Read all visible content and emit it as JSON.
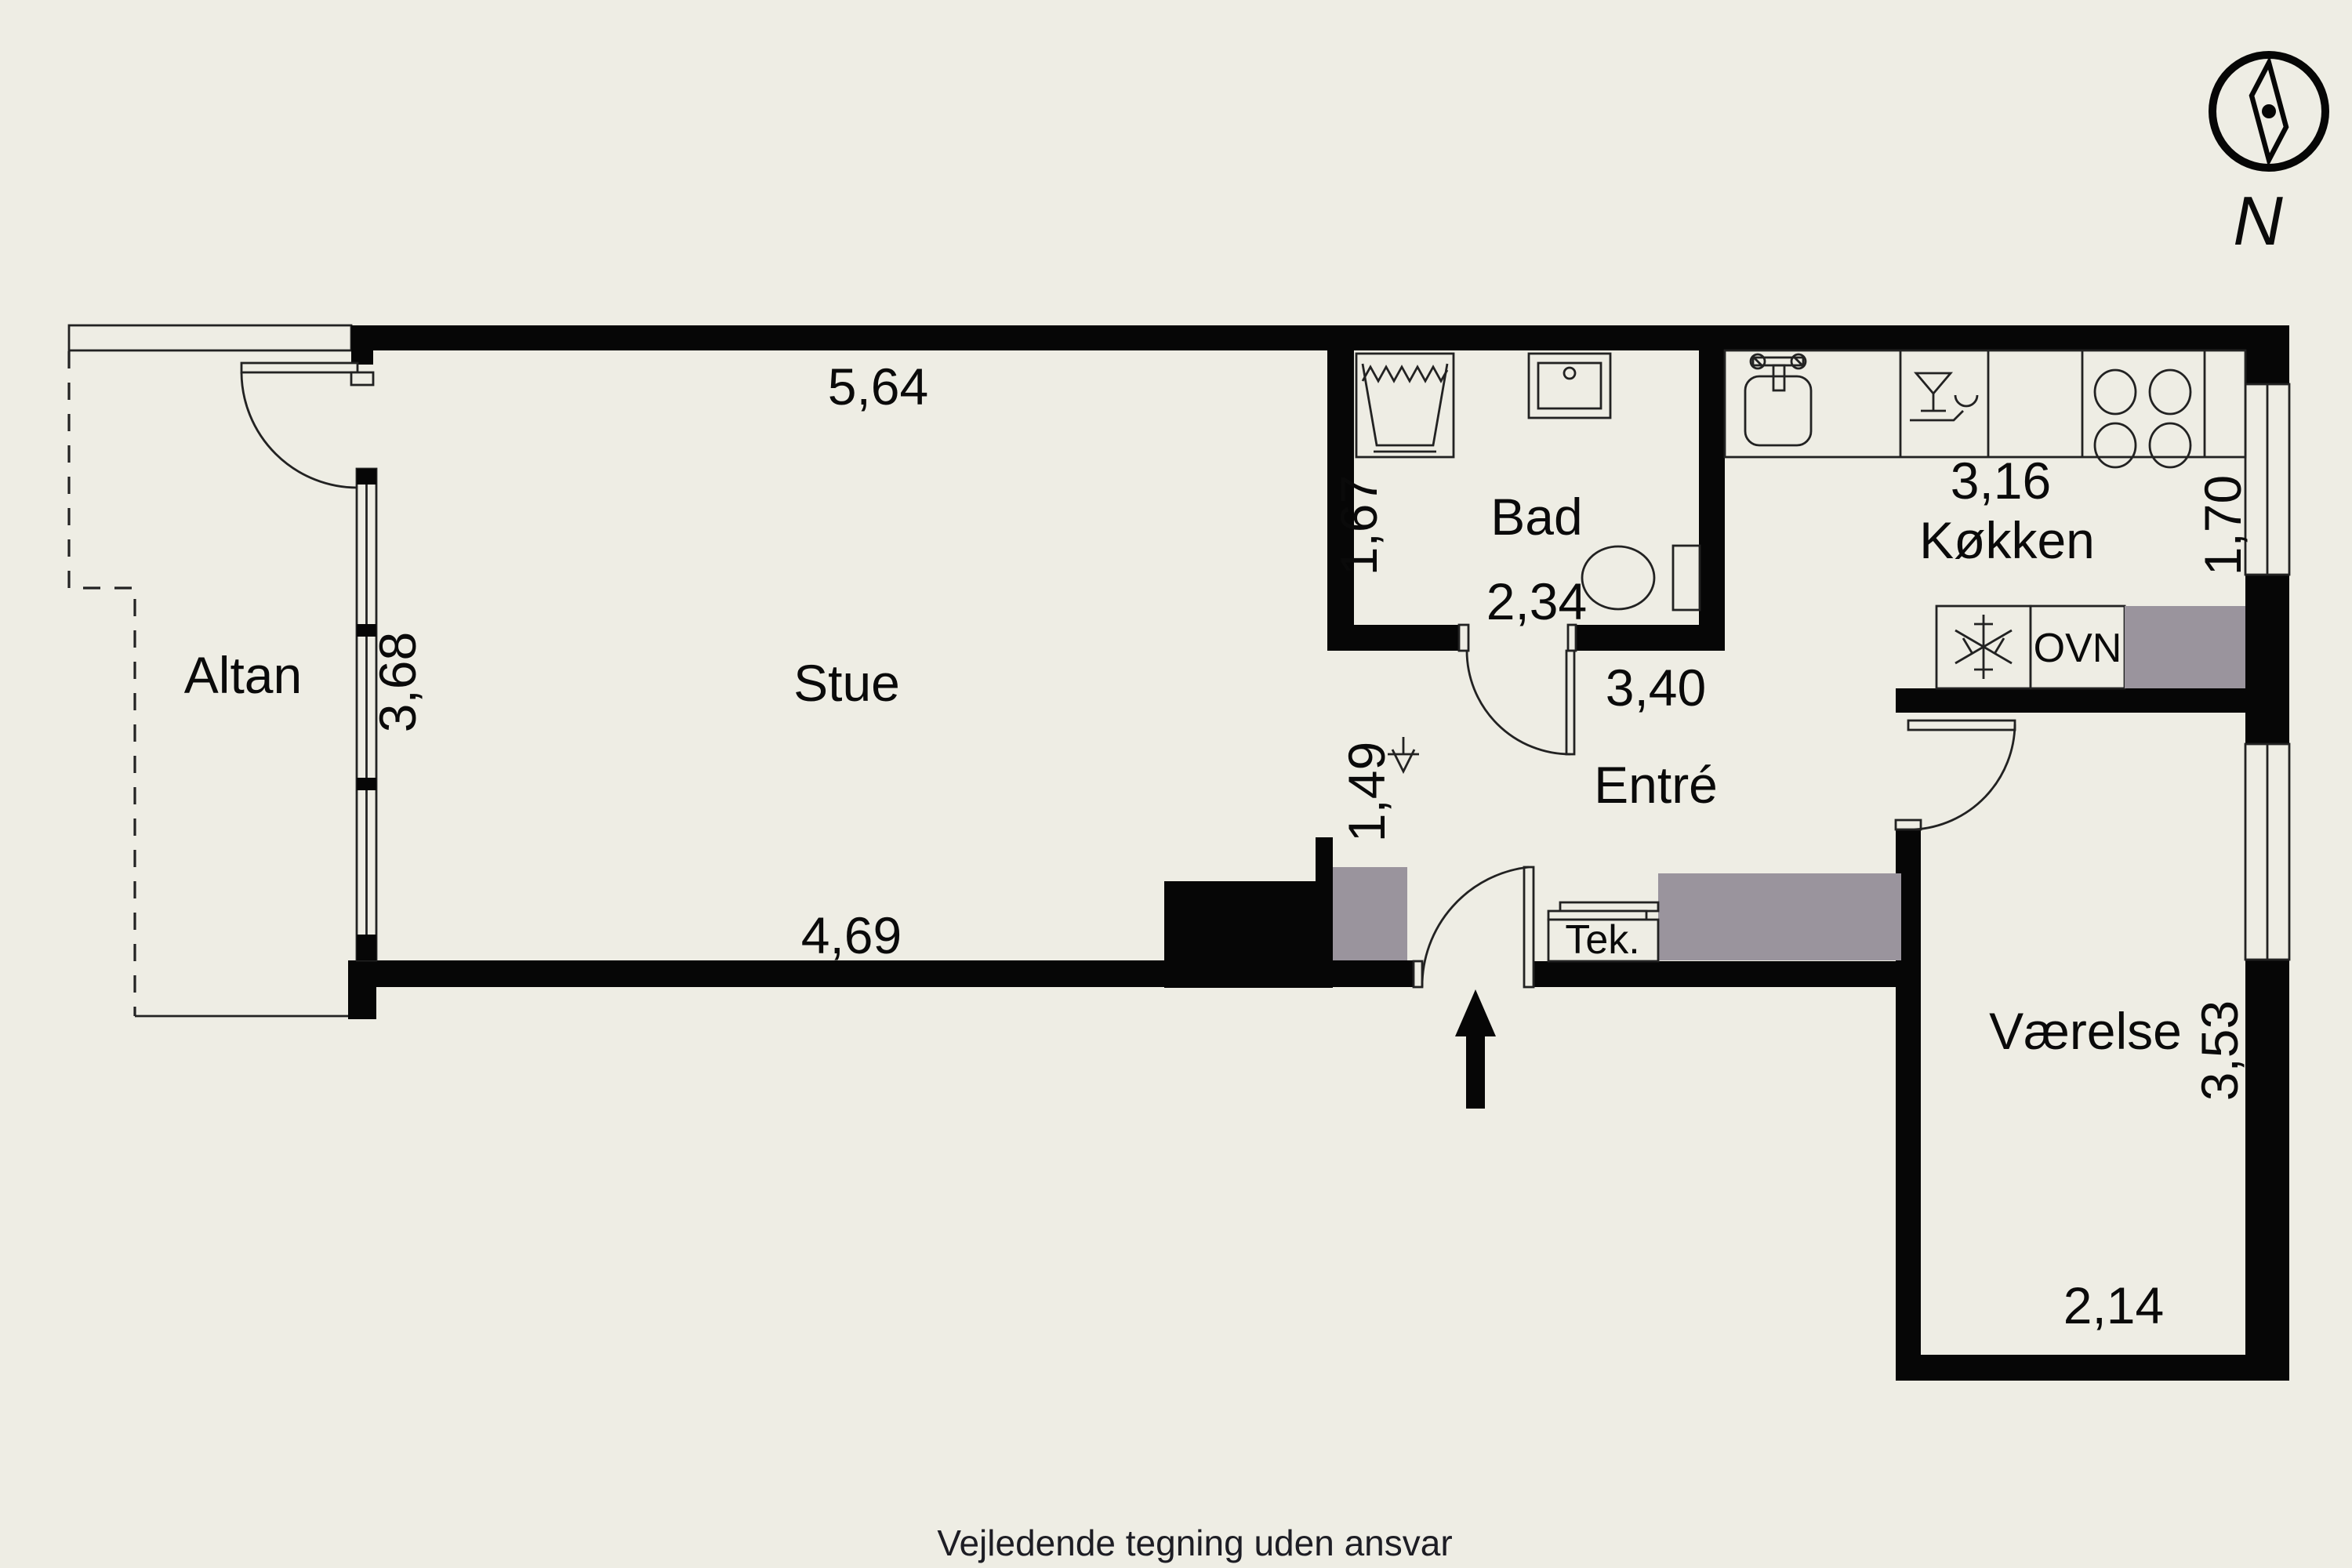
{
  "colors": {
    "background": "#EEEDE4",
    "wall": "#060606",
    "furniture": "#9A949D",
    "line": "#222222",
    "text": "#0A0A0A",
    "footer_text": "#1D1D24"
  },
  "compass": {
    "label": "N"
  },
  "rooms": {
    "altan": {
      "name": "Altan"
    },
    "stue": {
      "name": "Stue",
      "width_top": "5,64",
      "width_bottom": "4,69",
      "depth": "3,68"
    },
    "bad": {
      "name": "Bad",
      "width": "2,34",
      "depth": "1,67"
    },
    "entre": {
      "name": "Entré",
      "width": "3,40",
      "passage": "1,49"
    },
    "kokken": {
      "name": "Køkken",
      "width": "3,16",
      "depth": "1,70",
      "oven": "OVN"
    },
    "vaerelse": {
      "name": "Værelse",
      "width": "2,14",
      "depth": "3,53"
    },
    "tek": {
      "name": "Tek."
    }
  },
  "footer": {
    "disclaimer": "Vejledende tegning uden ansvar"
  }
}
